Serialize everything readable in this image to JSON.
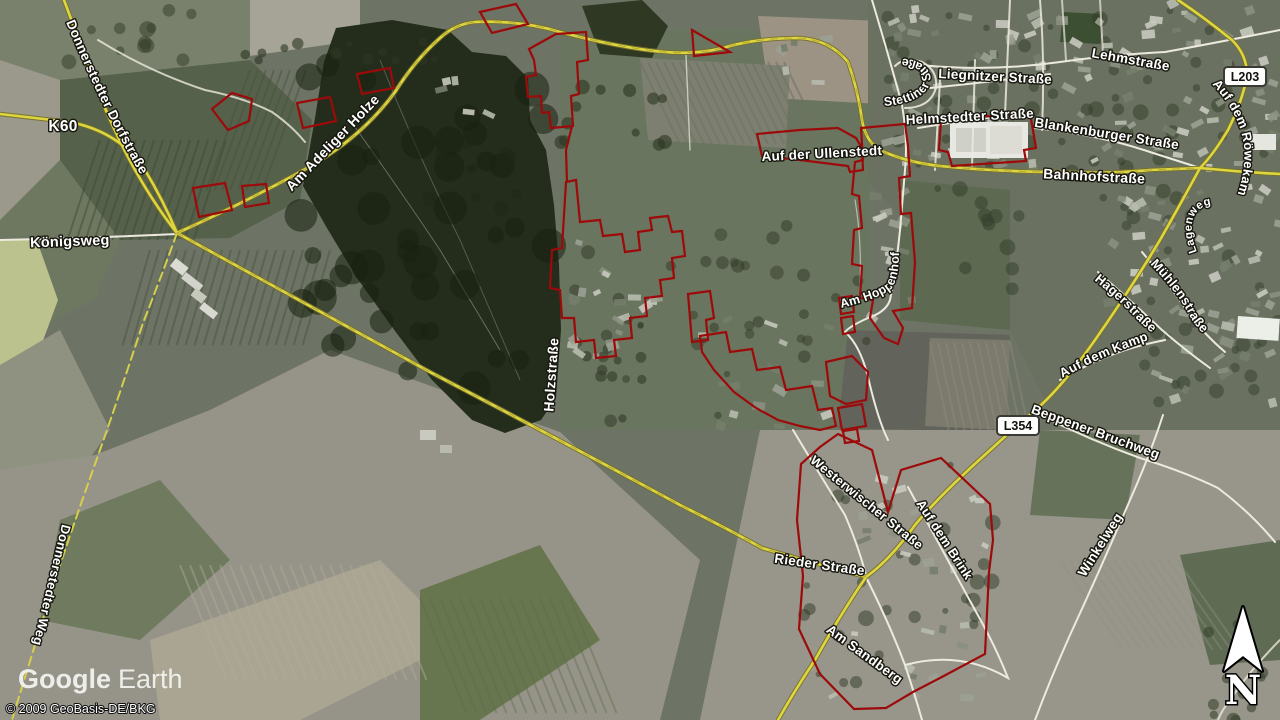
{
  "brand": {
    "logo_google": "Google",
    "logo_earth": "Earth",
    "copyright": "© 2009 GeoBasis-DE/BKG",
    "compass_n": "N"
  },
  "badges": {
    "l203": "L203",
    "l354": "L354"
  },
  "streets": {
    "k60": "K60",
    "donnerstedter_dorfstrasse": "Donnerstedter Dorfstraße",
    "koenigsweg": "Königsweg",
    "am_adeliger_holze": "Am Adeliger Holze",
    "holzstrasse": "Holzstraße",
    "donnerstedter_weg": "Donnerstedter Weg",
    "auf_der_ullenstedt": "Auf der Ullenstedt",
    "lehmstrasse": "Lehmstraße",
    "liegnitzer_strasse": "Liegnitzer Straße",
    "stettiner_strasse": "Stettiner Straße",
    "helmstedter_strasse": "Helmstedter Straße",
    "blankenburger_strasse": "Blankenburger Straße",
    "bahnhofstrasse": "Bahnhofstraße",
    "auf_dem_roewekamp": "Auf dem Röwekamp",
    "am_hoppenhof": "Am Hoppenhof",
    "lagenweg": "Lagenweg",
    "muehlenstrasse": "Mühlenstraße",
    "hagerstrasse": "Hagerstraße",
    "auf_dem_kamp": "Auf dem Kamp",
    "beppener_bruchweg": "Beppener Bruchweg",
    "winkelweg": "Winkelweg",
    "westerwischer_strasse": "Westerwischer Straße",
    "auf_dem_brink": "Auf dem Brink",
    "rieder_strasse": "Rieder Straße",
    "am_sandberg": "Am Sandberg"
  },
  "colors": {
    "boundary_red": "#9c0a0a",
    "road_yellow": "#ded63f",
    "road_white": "#eceade",
    "label_fill": "#ffffff",
    "label_halo": "#17170f"
  }
}
